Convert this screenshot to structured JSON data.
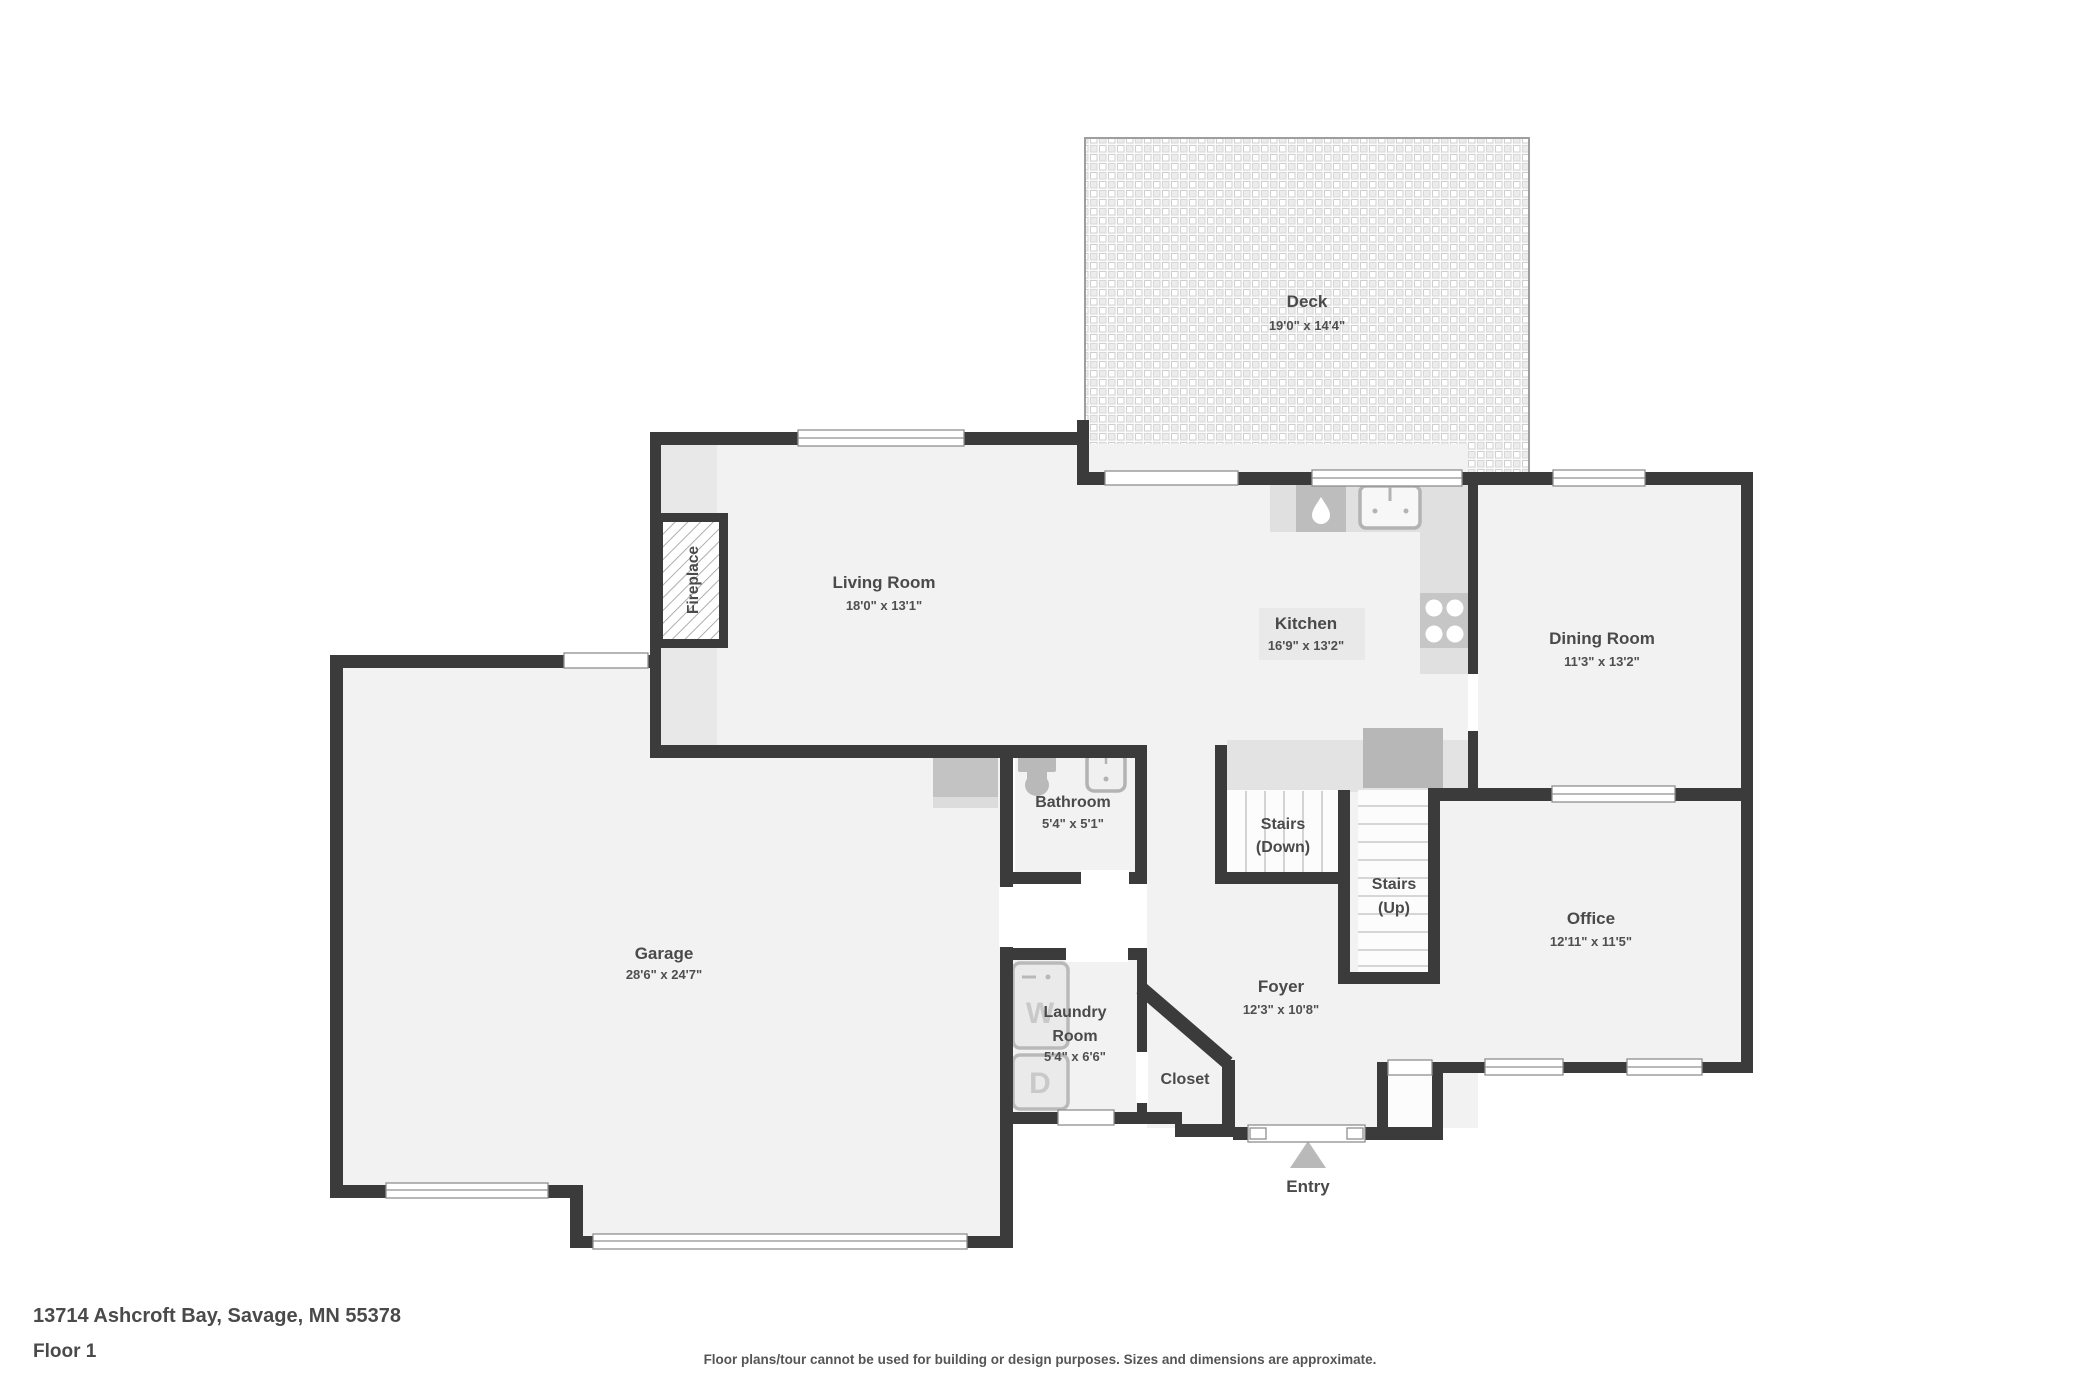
{
  "meta": {
    "address": "13714 Ashcroft Bay, Savage, MN 55378",
    "floor_label": "Floor 1",
    "disclaimer": "Floor plans/tour cannot be used for building or design purposes. Sizes and dimensions are approximate."
  },
  "colors": {
    "wall": "#3b3b3b",
    "floor": "#f2f2f2",
    "counter_gray": "#e0e0e0",
    "fixture_gray": "#b9b9b9",
    "label_text": "#4a4a4a"
  },
  "rooms": {
    "deck": {
      "name": "Deck",
      "dims": "19'0\" x 14'4\""
    },
    "living": {
      "name": "Living Room",
      "dims": "18'0\" x 13'1\""
    },
    "kitchen": {
      "name": "Kitchen",
      "dims": "16'9\" x 13'2\""
    },
    "dining": {
      "name": "Dining Room",
      "dims": "11'3\" x 13'2\""
    },
    "garage": {
      "name": "Garage",
      "dims": "28'6\" x 24'7\""
    },
    "bathroom": {
      "name": "Bathroom",
      "dims": "5'4\" x 5'1\""
    },
    "laundry": {
      "name_line1": "Laundry",
      "name_line2": "Room",
      "dims": "5'4\" x 6'6\""
    },
    "closet": {
      "name": "Closet"
    },
    "foyer": {
      "name": "Foyer",
      "dims": "12'3\" x 10'8\""
    },
    "office": {
      "name": "Office",
      "dims": "12'11\" x 11'5\""
    },
    "stairs_down": {
      "name_line1": "Stairs",
      "name_line2": "(Down)"
    },
    "stairs_up": {
      "name_line1": "Stairs",
      "name_line2": "(Up)"
    },
    "entry": {
      "name": "Entry"
    },
    "fireplace": {
      "name": "Fireplace"
    },
    "washer_letter": "W",
    "dryer_letter": "D"
  }
}
